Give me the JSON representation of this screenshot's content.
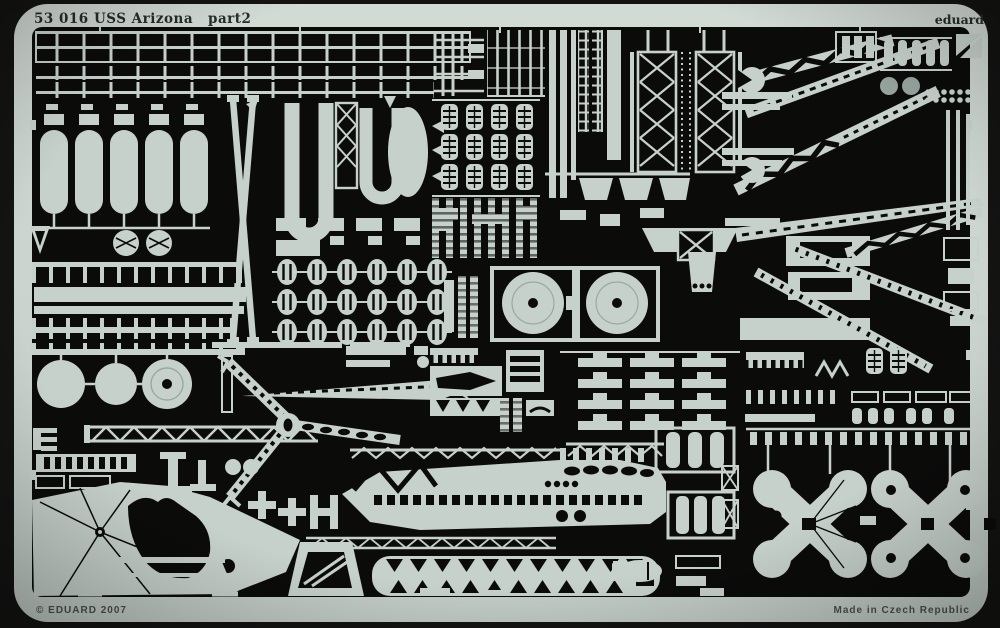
{
  "sheet": {
    "part_number": "53 016",
    "kit_name": "USS Arizona",
    "part_label": "part2",
    "brand": "eduard",
    "copyright": "© EDUARD 2007",
    "made_in": "Made in Czech Republic"
  },
  "colors": {
    "background": "#131312",
    "metal": "#c7d1cb",
    "metal_bright": "#d9e0dc",
    "etched": "#0b0b0a",
    "stamp": "#262c29",
    "grey_part": "#97a49e"
  }
}
